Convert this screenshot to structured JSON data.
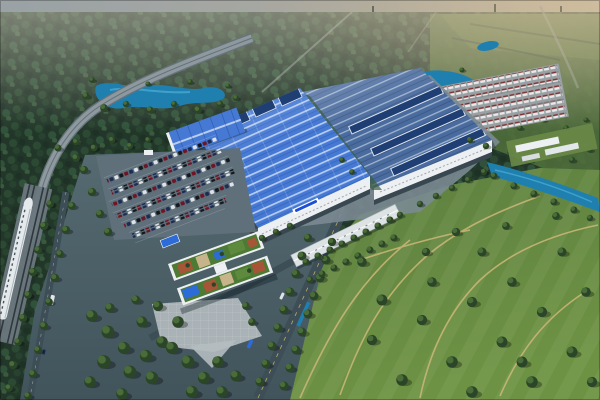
{
  "scene": {
    "type": "aerial-architectural-rendering",
    "elements": [
      {
        "name": "forest-horizon"
      },
      {
        "name": "elevated-rail-viaduct"
      },
      {
        "name": "high-speed-train"
      },
      {
        "name": "lake-west"
      },
      {
        "name": "lake-east"
      },
      {
        "name": "main-assembly-hall"
      },
      {
        "name": "second-assembly-hall"
      },
      {
        "name": "warehouse"
      },
      {
        "name": "employee-parking-lot"
      },
      {
        "name": "office-rooftop-garden"
      },
      {
        "name": "entrance-plaza"
      },
      {
        "name": "vehicle-storage-yard"
      },
      {
        "name": "linear-canopy-building"
      },
      {
        "name": "water-channel"
      },
      {
        "name": "green-fields"
      }
    ],
    "trees_back": [
      [
        86,
        96,
        1.1
      ],
      [
        104,
        108,
        1.2
      ],
      [
        126,
        104,
        1.0
      ],
      [
        150,
        110,
        1.1
      ],
      [
        174,
        104,
        1.0
      ],
      [
        198,
        110,
        1.2
      ],
      [
        220,
        104,
        1.0
      ],
      [
        236,
        98,
        0.9
      ],
      [
        92,
        80,
        0.9
      ],
      [
        148,
        84,
        0.8
      ],
      [
        190,
        82,
        0.9
      ],
      [
        228,
        86,
        0.8
      ],
      [
        408,
        94,
        1.0
      ],
      [
        428,
        100,
        1.1
      ],
      [
        452,
        98,
        1.0
      ],
      [
        472,
        94,
        0.9
      ],
      [
        414,
        72,
        0.8
      ],
      [
        462,
        70,
        0.8
      ],
      [
        500,
        120,
        0.8
      ],
      [
        520,
        128,
        0.9
      ],
      [
        544,
        120,
        0.8
      ],
      [
        566,
        128,
        0.9
      ],
      [
        586,
        120,
        0.8
      ],
      [
        590,
        150,
        0.9
      ],
      [
        572,
        160,
        1.0
      ],
      [
        550,
        154,
        0.9
      ],
      [
        530,
        160,
        1.0
      ],
      [
        510,
        152,
        0.9
      ],
      [
        428,
        118,
        1.0
      ],
      [
        440,
        132,
        1.1
      ],
      [
        456,
        138,
        1.0
      ],
      [
        58,
        148,
        1.1
      ],
      [
        76,
        142,
        1.0
      ],
      [
        94,
        148,
        1.1
      ],
      [
        112,
        140,
        1.0
      ],
      [
        130,
        146,
        1.0
      ],
      [
        148,
        140,
        0.9
      ],
      [
        250,
        136,
        0.9
      ],
      [
        268,
        130,
        0.9
      ]
    ],
    "trees_front": [
      [
        50,
        204,
        1.2
      ],
      [
        44,
        226,
        1.3
      ],
      [
        38,
        250,
        1.2
      ],
      [
        33,
        272,
        1.3
      ],
      [
        28,
        295,
        1.2
      ],
      [
        23,
        318,
        1.3
      ],
      [
        18,
        342,
        1.2
      ],
      [
        13,
        365,
        1.3
      ],
      [
        9,
        388,
        1.2
      ],
      [
        72,
        206,
        1.2
      ],
      [
        66,
        230,
        1.3
      ],
      [
        60,
        254,
        1.2
      ],
      [
        55,
        278,
        1.3
      ],
      [
        49,
        302,
        1.2
      ],
      [
        44,
        326,
        1.3
      ],
      [
        38,
        350,
        1.2
      ],
      [
        33,
        374,
        1.3
      ],
      [
        28,
        396,
        1.2
      ],
      [
        84,
        170,
        1.3
      ],
      [
        92,
        192,
        1.3
      ],
      [
        100,
        214,
        1.3
      ],
      [
        108,
        232,
        1.3
      ],
      [
        76,
        158,
        1.2
      ],
      [
        92,
        316,
        1.8
      ],
      [
        108,
        332,
        2.0
      ],
      [
        124,
        348,
        1.9
      ],
      [
        104,
        362,
        2.1
      ],
      [
        90,
        382,
        1.8
      ],
      [
        130,
        372,
        2.0
      ],
      [
        146,
        356,
        1.9
      ],
      [
        162,
        342,
        1.8
      ],
      [
        142,
        322,
        1.7
      ],
      [
        158,
        306,
        1.6
      ],
      [
        178,
        322,
        1.8
      ],
      [
        172,
        348,
        1.9
      ],
      [
        188,
        362,
        2.0
      ],
      [
        204,
        378,
        1.9
      ],
      [
        218,
        362,
        1.8
      ],
      [
        192,
        392,
        1.9
      ],
      [
        122,
        394,
        1.8
      ],
      [
        222,
        392,
        1.8
      ],
      [
        236,
        376,
        1.7
      ],
      [
        152,
        378,
        2.0
      ],
      [
        110,
        308,
        1.5
      ],
      [
        136,
        300,
        1.4
      ],
      [
        260,
        382,
        1.4
      ],
      [
        266,
        364,
        1.4
      ],
      [
        272,
        346,
        1.4
      ],
      [
        278,
        328,
        1.4
      ],
      [
        284,
        310,
        1.4
      ],
      [
        290,
        292,
        1.4
      ],
      [
        296,
        274,
        1.4
      ],
      [
        302,
        256,
        1.4
      ],
      [
        308,
        238,
        1.3
      ],
      [
        284,
        386,
        1.4
      ],
      [
        290,
        368,
        1.4
      ],
      [
        296,
        350,
        1.4
      ],
      [
        302,
        332,
        1.4
      ],
      [
        308,
        314,
        1.4
      ],
      [
        314,
        296,
        1.4
      ],
      [
        320,
        278,
        1.4
      ],
      [
        326,
        260,
        1.4
      ],
      [
        332,
        242,
        1.3
      ],
      [
        306,
        262,
        1.1
      ],
      [
        318,
        256,
        1.1
      ],
      [
        330,
        250,
        1.1
      ],
      [
        342,
        244,
        1.1
      ],
      [
        354,
        238,
        1.1
      ],
      [
        366,
        232,
        1.1
      ],
      [
        378,
        226,
        1.1
      ],
      [
        390,
        220,
        1.1
      ],
      [
        400,
        215,
        1.0
      ],
      [
        310,
        280,
        1.1
      ],
      [
        322,
        274,
        1.1
      ],
      [
        334,
        268,
        1.1
      ],
      [
        346,
        262,
        1.1
      ],
      [
        358,
        256,
        1.1
      ],
      [
        370,
        250,
        1.1
      ],
      [
        382,
        244,
        1.1
      ],
      [
        394,
        238,
        1.1
      ],
      [
        362,
        262,
        1.5
      ],
      [
        382,
        300,
        1.7
      ],
      [
        372,
        340,
        1.6
      ],
      [
        402,
        380,
        1.8
      ],
      [
        422,
        320,
        1.6
      ],
      [
        432,
        282,
        1.5
      ],
      [
        452,
        362,
        1.8
      ],
      [
        472,
        302,
        1.6
      ],
      [
        482,
        252,
        1.4
      ],
      [
        502,
        342,
        1.7
      ],
      [
        512,
        282,
        1.5
      ],
      [
        532,
        382,
        1.8
      ],
      [
        542,
        312,
        1.6
      ],
      [
        562,
        252,
        1.4
      ],
      [
        572,
        352,
        1.7
      ],
      [
        586,
        292,
        1.5
      ],
      [
        592,
        382,
        1.6
      ],
      [
        456,
        232,
        1.3
      ],
      [
        506,
        226,
        1.2
      ],
      [
        556,
        216,
        1.2
      ],
      [
        472,
        392,
        1.8
      ],
      [
        522,
        362,
        1.7
      ],
      [
        426,
        252,
        1.3
      ],
      [
        494,
        176,
        1.1
      ],
      [
        514,
        186,
        1.1
      ],
      [
        534,
        194,
        1.1
      ],
      [
        554,
        202,
        1.1
      ],
      [
        574,
        210,
        1.1
      ],
      [
        590,
        218,
        1.0
      ],
      [
        262,
        238,
        1.0
      ],
      [
        276,
        232,
        1.0
      ],
      [
        290,
        226,
        1.0
      ],
      [
        342,
        160,
        0.9
      ],
      [
        352,
        172,
        0.9
      ],
      [
        420,
        204,
        1.0
      ],
      [
        436,
        196,
        1.0
      ],
      [
        452,
        188,
        1.0
      ],
      [
        468,
        180,
        1.0
      ],
      [
        484,
        172,
        1.0
      ],
      [
        246,
        306,
        1.2
      ],
      [
        252,
        322,
        1.2
      ],
      [
        470,
        140,
        1.0
      ],
      [
        486,
        146,
        1.0
      ]
    ]
  },
  "palette": {
    "sky_left": "#9aa2a6",
    "sky_right": "#c6bba6",
    "forest_base": "#22372a",
    "forest_mid": "#2e4a34",
    "forest_light": "#3c5c40",
    "field_far": "#51703c",
    "field_far_light": "#638244",
    "grass": "#6d9244",
    "grass_dark": "#4f7336",
    "path_tan": "#cdb878",
    "tree_dark": "#2a4527",
    "tree_light": "#4a6c38",
    "water": "#1f80b0",
    "water_deep": "#135e85",
    "water_light": "#55b6dc",
    "viaduct": "#8d989f",
    "viaduct_edge": "#67737a",
    "track": "#2e383d",
    "train_white": "#e4e9ec",
    "train_shade": "#aab4bb",
    "pavement": "#566a72",
    "pavement_dark": "#41545b",
    "factory_apron": "#7b8992",
    "plaza": "#a9b2b6",
    "road": "#3e4e56",
    "road_line": "#d9c36c",
    "roof_blue": "#4579d4",
    "roof_rib": "#b7cdf2",
    "roof_blue_deep": "#2c58a8",
    "roof_steel": "#4a6b9e",
    "monitor_blue": "#1f3e74",
    "monitor_frame": "#dde4ec",
    "facade_white": "#edf0f2",
    "facade_shade": "#c6cdd2",
    "base_dark": "#394750",
    "logo_blue": "#1d4ed8",
    "car_red": "#6f1626",
    "car_navy": "#1d2c55",
    "car_black": "#15191e",
    "car_white": "#dde2e6",
    "canopy_blue": "#2d6bd6",
    "terracotta": "#a65636",
    "garden_green": "#4d7a34",
    "deck_tan": "#c8b48a",
    "house_body": "#e8eaea",
    "house_roof": "#7a3030",
    "yard_ground": "#98a0a3",
    "shadow": "rgba(10,22,28,0.35)"
  }
}
